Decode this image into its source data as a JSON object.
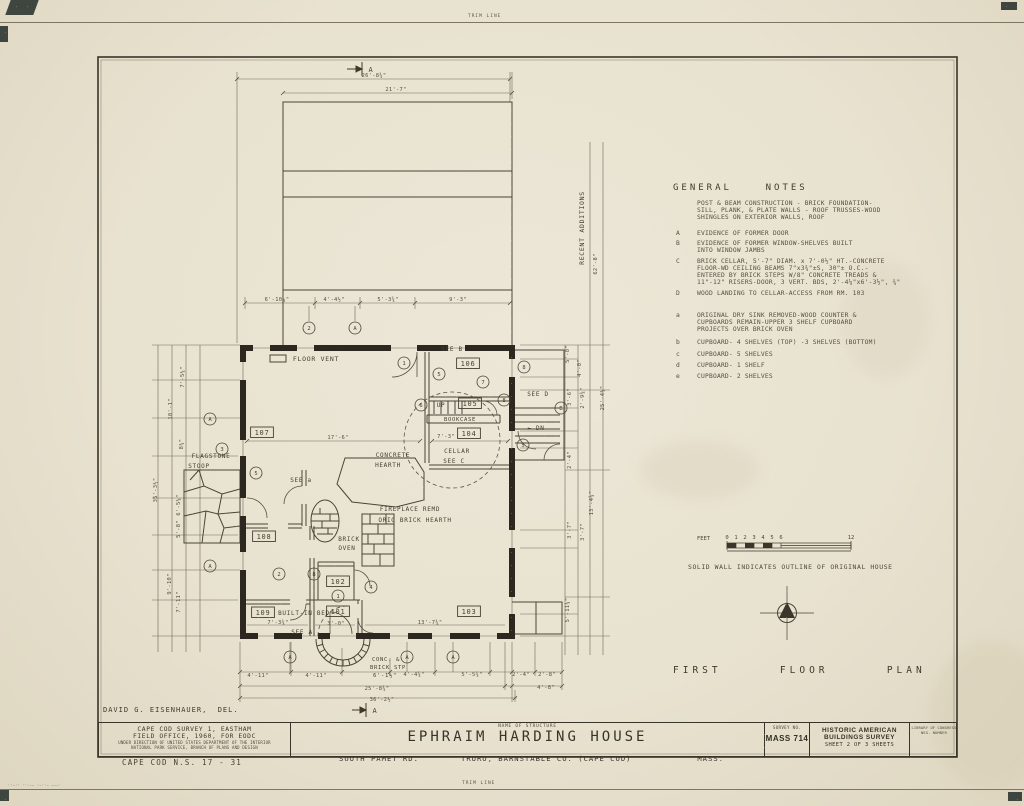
{
  "sheet": {
    "trim_top": "TRIM LINE",
    "trim_bottom": "TRIM LINE",
    "delineator": "DAVID G. EISENHAUER,  DEL.",
    "footer_id": "CAPE COD N.S. 17 - 31",
    "plan_title": "FIRST      FLOOR      PLAN"
  },
  "general_notes": {
    "title": "GENERAL    NOTES",
    "intro": "POST & BEAM CONSTRUCTION - BRICK FOUNDATION-\nSILL, PLANK, & PLATE WALLS - ROOF TRUSSES-WOOD\nSHINGLES ON EXTERIOR WALLS, ROOF",
    "items": [
      {
        "key": "A",
        "text": "EVIDENCE OF FORMER DOOR"
      },
      {
        "key": "B",
        "text": "EVIDENCE OF FORMER WINDOW-SHELVES BUILT\nINTO WINDOW JAMBS"
      },
      {
        "key": "C",
        "text": "BRICK CELLAR, 5'-7\" DIAM. x 7'-0½\" HT.-CONCRETE\nFLOOR-WD CEILING BEAMS 7\"x3¾\"±S, 30\"± O.C.-\nENTERED BY BRICK STEPS W/8\" CONCRETE TREADS &\n11\"-12\" RISERS-DOOR, 3 VERT. BDS, 2'-4¼\"x6'-3½\", ¾\""
      },
      {
        "key": "D",
        "text": "WOOD LANDING TO CELLAR-ACCESS FROM RM. 103"
      },
      {
        "key": "a",
        "text": "ORIGINAL DRY SINK REMOVED-WOOD COUNTER &\nCUPBOARDS REMAIN-UPPER 3 SHELF CUPBOARD\nPROJECTS OVER BRICK OVEN"
      },
      {
        "key": "b",
        "text": "CUPBOARD- 4 SHELVES (TOP) -3 SHELVES (BOTTOM)"
      },
      {
        "key": "c",
        "text": "CUPBOARD- 5 SHELVES"
      },
      {
        "key": "d",
        "text": "CUPBOARD- 1 SHELF"
      },
      {
        "key": "e",
        "text": "CUPBOARD- 2 SHELVES"
      }
    ],
    "legend": "SOLID WALL INDICATES OUTLINE OF ORIGINAL HOUSE"
  },
  "scale_bar": {
    "unit": "FEET",
    "ticks": [
      "0",
      "1",
      "2",
      "3",
      "4",
      "5",
      "6",
      "12"
    ]
  },
  "title_block": {
    "office_line1": "CAPE COD SURVEY 1, EASTHAM",
    "office_line2": "FIELD OFFICE, 1960, FOR EODC",
    "office_line3": "UNDER DIRECTION OF UNITED STATES DEPARTMENT OF THE INTERIOR",
    "office_line4": "NATIONAL PARK SERVICE, BRANCH OF PLANS AND DESIGN",
    "name_label": "NAME OF STRUCTURE",
    "structure_name": "EPHRAIM HARDING HOUSE",
    "address1": "SOUTH PAMET RD.",
    "address2": "TRURO, BARNSTABLE CO. (CAPE COD)",
    "address3": "MASS.",
    "survey_no_label": "SURVEY NO.",
    "survey_no": "MASS 714",
    "habs_line1": "HISTORIC AMERICAN",
    "habs_line2": "BUILDINGS SURVEY",
    "habs_line3": "SHEET 2 OF 3 SHEETS",
    "loc_line1": "LIBRARY OF CONGRESS",
    "loc_line2": "NEG. NUMBER"
  },
  "plan": {
    "dims": [
      {
        "t": "26'-8¾\"",
        "x": 374,
        "y": 77
      },
      {
        "t": "21'-7\"",
        "x": 396,
        "y": 91
      },
      {
        "t": "6'-10¼\"",
        "x": 277,
        "y": 301
      },
      {
        "t": "4'-4½\"",
        "x": 334,
        "y": 301
      },
      {
        "t": "5'-3¾\"",
        "x": 388,
        "y": 301
      },
      {
        "t": "9'-3\"",
        "x": 458,
        "y": 301
      },
      {
        "t": "7'-5¼\"",
        "x": 184,
        "y": 377,
        "r": -90
      },
      {
        "t": "10'-1\"",
        "x": 172,
        "y": 409,
        "r": -90
      },
      {
        "t": "8¼\"",
        "x": 183,
        "y": 444,
        "r": -90
      },
      {
        "t": "35'-3½\"",
        "x": 157,
        "y": 490,
        "r": -90
      },
      {
        "t": "6'-5¼\"",
        "x": 180,
        "y": 505,
        "r": -90
      },
      {
        "t": "5'-8\"",
        "x": 180,
        "y": 529,
        "r": -90
      },
      {
        "t": "9'-10\"",
        "x": 171,
        "y": 584,
        "r": -90
      },
      {
        "t": "7'-11\"",
        "x": 180,
        "y": 602,
        "r": -90
      },
      {
        "t": "5'-0\"",
        "x": 569,
        "y": 354,
        "r": -90
      },
      {
        "t": "4'-0\"",
        "x": 581,
        "y": 368,
        "r": -90
      },
      {
        "t": "3'-6\"",
        "x": 571,
        "y": 397,
        "r": -90
      },
      {
        "t": "2'-9¾\"",
        "x": 584,
        "y": 398,
        "r": -90
      },
      {
        "t": "25'-4½\"",
        "x": 604,
        "y": 398,
        "r": -90
      },
      {
        "t": "2'-4\"",
        "x": 571,
        "y": 460,
        "r": -90
      },
      {
        "t": "13'-4¾\"",
        "x": 593,
        "y": 503,
        "r": -90
      },
      {
        "t": "3'-7\"",
        "x": 571,
        "y": 530,
        "r": -90
      },
      {
        "t": "3'-7\"",
        "x": 584,
        "y": 532,
        "r": -90
      },
      {
        "t": "5'-11¾\"",
        "x": 569,
        "y": 610,
        "r": -90
      },
      {
        "t": "62'-8\"",
        "x": 597,
        "y": 264,
        "r": -90
      },
      {
        "t": "4'-11\"",
        "x": 258,
        "y": 677
      },
      {
        "t": "4'-11\"",
        "x": 316,
        "y": 677
      },
      {
        "t": "4'-4¾\"",
        "x": 414,
        "y": 676
      },
      {
        "t": "5'-5¾\"",
        "x": 472,
        "y": 676
      },
      {
        "t": "2'-4\"",
        "x": 521,
        "y": 676
      },
      {
        "t": "2'-8\"",
        "x": 547,
        "y": 676
      },
      {
        "t": "25'-8¾\"",
        "x": 377,
        "y": 690
      },
      {
        "t": "4'-8\"",
        "x": 546,
        "y": 689
      },
      {
        "t": "36'-2½\"",
        "x": 382,
        "y": 701
      },
      {
        "t": "17'-6\"",
        "x": 338,
        "y": 439
      },
      {
        "t": "7'-3\"",
        "x": 446,
        "y": 438
      },
      {
        "t": "7'-3¾\"",
        "x": 278,
        "y": 624
      },
      {
        "t": "13'-7¾\"",
        "x": 430,
        "y": 624
      },
      {
        "t": "3'-0\"",
        "x": 336,
        "y": 625
      }
    ],
    "labels": [
      {
        "t": "FLOOR  VENT",
        "x": 316,
        "y": 361
      },
      {
        "t": "SEE B",
        "x": 452,
        "y": 351,
        "s": 6
      },
      {
        "t": "106",
        "x": 468,
        "y": 366,
        "b": 1,
        "s": 7
      },
      {
        "t": "UP",
        "x": 441,
        "y": 407,
        "s": 6
      },
      {
        "t": "105",
        "x": 470,
        "y": 406,
        "b": 1,
        "s": 7
      },
      {
        "t": "BOOKCASE",
        "x": 460,
        "y": 421,
        "s": 5.5
      },
      {
        "t": "104",
        "x": 469,
        "y": 436,
        "b": 1,
        "s": 7
      },
      {
        "t": "SEE D",
        "x": 538,
        "y": 396,
        "s": 6
      },
      {
        "t": "← DN",
        "x": 536,
        "y": 430,
        "s": 6
      },
      {
        "t": "CELLAR",
        "x": 457,
        "y": 453,
        "s": 6
      },
      {
        "t": "SEE C",
        "x": 454,
        "y": 463,
        "s": 6
      },
      {
        "t": "CONCRETE",
        "x": 393,
        "y": 457,
        "s": 6
      },
      {
        "t": "HEARTH",
        "x": 388,
        "y": 467,
        "s": 6
      },
      {
        "t": "FIREPLACE REMD",
        "x": 410,
        "y": 511,
        "s": 6
      },
      {
        "t": "ORIG BRICK HEARTH",
        "x": 415,
        "y": 522,
        "s": 6
      },
      {
        "t": "BRICK",
        "x": 349,
        "y": 541,
        "s": 6
      },
      {
        "t": "OVEN",
        "x": 347,
        "y": 550,
        "s": 6
      },
      {
        "t": "107",
        "x": 262,
        "y": 435,
        "b": 1,
        "s": 7
      },
      {
        "t": "108",
        "x": 264,
        "y": 539,
        "b": 1,
        "s": 7
      },
      {
        "t": "SEE a",
        "x": 301,
        "y": 482,
        "s": 6
      },
      {
        "t": "102",
        "x": 338,
        "y": 584,
        "b": 1,
        "s": 7
      },
      {
        "t": "101",
        "x": 338,
        "y": 614,
        "b": 1,
        "s": 7
      },
      {
        "t": "109",
        "x": 263,
        "y": 615,
        "b": 1,
        "s": 7
      },
      {
        "t": "BUILT-IN BED",
        "x": 304,
        "y": 615,
        "s": 6
      },
      {
        "t": "103",
        "x": 469,
        "y": 614,
        "b": 1,
        "s": 7
      },
      {
        "t": "SEE A",
        "x": 302,
        "y": 634,
        "s": 6
      },
      {
        "t": "FLAGSTONE",
        "x": 211,
        "y": 458,
        "s": 6
      },
      {
        "t": "STOOP",
        "x": 199,
        "y": 468,
        "s": 6
      },
      {
        "t": "CONC. &",
        "x": 386,
        "y": 661,
        "s": 5.5
      },
      {
        "t": "BRICK STP",
        "x": 388,
        "y": 669,
        "s": 5.5
      },
      {
        "t": "6'-1½\"",
        "x": 385,
        "y": 677,
        "s": 5.5
      },
      {
        "t": "RECENT  ADDITIONS",
        "x": 584,
        "y": 228,
        "r": -90,
        "s": 6.5
      },
      {
        "t": "A",
        "x": 371,
        "y": 72,
        "s": 7
      },
      {
        "t": "A",
        "x": 375,
        "y": 713,
        "s": 7
      }
    ],
    "circles": [
      {
        "t": "2",
        "x": 309,
        "y": 328
      },
      {
        "t": "A",
        "x": 355,
        "y": 328
      },
      {
        "t": "1",
        "x": 404,
        "y": 363
      },
      {
        "t": "5",
        "x": 439,
        "y": 374
      },
      {
        "t": "6",
        "x": 421,
        "y": 405
      },
      {
        "t": "7",
        "x": 483,
        "y": 382
      },
      {
        "t": "8",
        "x": 504,
        "y": 400
      },
      {
        "t": "8",
        "x": 524,
        "y": 367
      },
      {
        "t": "B",
        "x": 561,
        "y": 408
      },
      {
        "t": "A",
        "x": 210,
        "y": 419
      },
      {
        "t": "3",
        "x": 222,
        "y": 449
      },
      {
        "t": "A",
        "x": 210,
        "y": 566
      },
      {
        "t": "5",
        "x": 256,
        "y": 473
      },
      {
        "t": "2",
        "x": 279,
        "y": 574
      },
      {
        "t": "8",
        "x": 314,
        "y": 574
      },
      {
        "t": "1",
        "x": 338,
        "y": 596
      },
      {
        "t": "4",
        "x": 371,
        "y": 587
      },
      {
        "t": "5",
        "x": 523,
        "y": 445
      },
      {
        "t": "A",
        "x": 290,
        "y": 657
      },
      {
        "t": "A",
        "x": 407,
        "y": 657
      },
      {
        "t": "A",
        "x": 453,
        "y": 657
      }
    ]
  }
}
